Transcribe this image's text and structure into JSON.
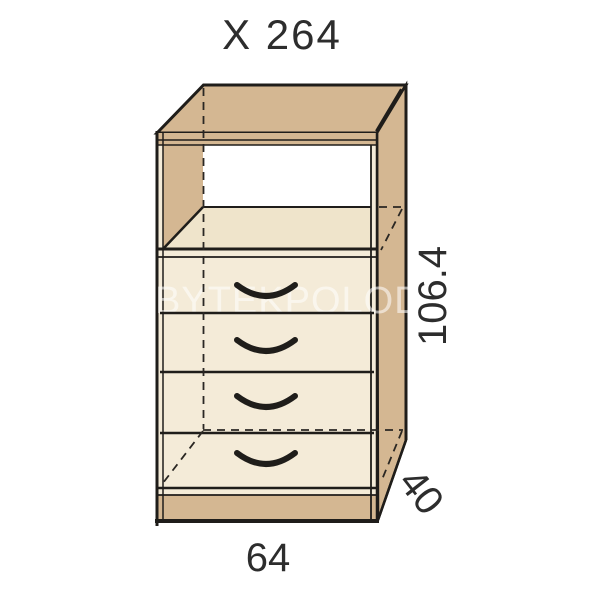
{
  "diagram": {
    "product_code": "X 264",
    "watermark": "BYTEKPOLODN",
    "dimensions": {
      "height": "106.4",
      "depth": "40",
      "width": "64"
    },
    "drawer_count": 4,
    "colors": {
      "wood_tan": "#d4b792",
      "panel_cream": "#f4ebd8",
      "shelf_cream": "#efe4cb",
      "outline": "#1f1d1a",
      "label_text": "#2d2d2d",
      "watermark_tint": "rgba(255,255,255,0.55)"
    }
  }
}
